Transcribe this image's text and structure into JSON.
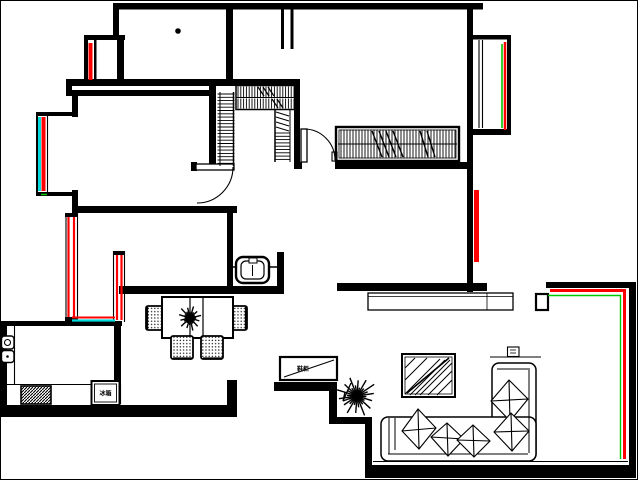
{
  "colors": {
    "wall": "#000000",
    "background": "#ffffff",
    "marker_red": "#ff0000",
    "marker_green": "#00c800",
    "marker_cyan": "#00dcdc"
  },
  "labels": {
    "fridge": "冰箱",
    "shoe_cabinet": "鞋柜"
  },
  "fixtures": [
    "bay-window",
    "walk-in-closet-hangers",
    "master-wardrobe-hangers",
    "interior-door-arcs",
    "toilet",
    "kitchen-sink",
    "gas-stove",
    "refrigerator",
    "dining-table",
    "dining-chairs",
    "dining-plant",
    "shoe-cabinet",
    "entry-arrow",
    "living-room-plant",
    "coffee-table",
    "l-shaped-sofa",
    "sofa-pillows",
    "side-table",
    "balcony-windows",
    "ac-ledge"
  ]
}
